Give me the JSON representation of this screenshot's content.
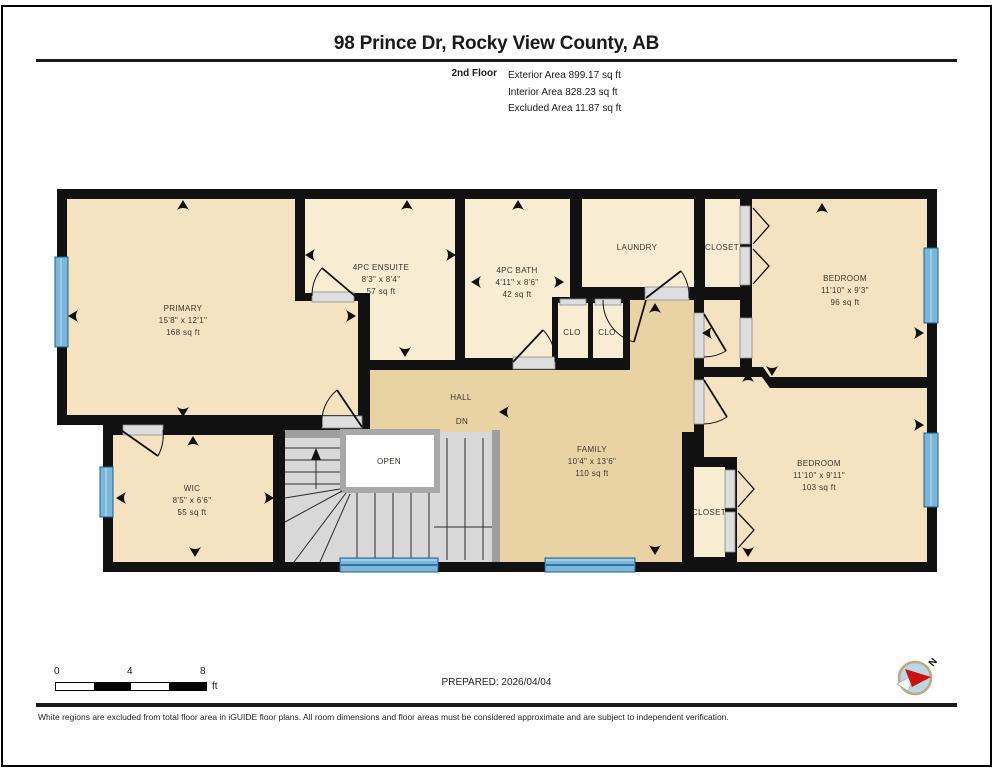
{
  "header": {
    "title": "98 Prince Dr, Rocky View County, AB",
    "floor_label": "2nd Floor",
    "area_lines": [
      "Exterior Area 899.17 sq ft",
      "Interior Area 828.23 sq ft",
      "Excluded Area 11.87 sq ft"
    ]
  },
  "plan": {
    "floor_name": "2nd Floor",
    "labels": [
      {
        "lines": [
          "PRIMARY",
          "15'8\" x 12'1\"",
          "168 sq ft"
        ],
        "x": 183,
        "y": 311
      },
      {
        "lines": [
          "4PC ENSUITE",
          "8'3\" x 8'4\"",
          "57 sq ft"
        ],
        "x": 381,
        "y": 270
      },
      {
        "lines": [
          "4PC BATH",
          "4'11\" x 8'6\"",
          "42 sq ft"
        ],
        "x": 517,
        "y": 273
      },
      {
        "lines": [
          "LAUNDRY"
        ],
        "x": 637,
        "y": 250
      },
      {
        "lines": [
          "CLOSET"
        ],
        "x": 722,
        "y": 250
      },
      {
        "lines": [
          "BEDROOM",
          "11'10\" x 9'3\"",
          "96 sq ft"
        ],
        "x": 845,
        "y": 281
      },
      {
        "lines": [
          "CLO"
        ],
        "x": 572,
        "y": 335
      },
      {
        "lines": [
          "CLO"
        ],
        "x": 607,
        "y": 335
      },
      {
        "lines": [
          "HALL"
        ],
        "x": 461,
        "y": 400
      },
      {
        "lines": [
          "DN"
        ],
        "x": 462,
        "y": 424
      },
      {
        "lines": [
          "OPEN"
        ],
        "x": 389,
        "y": 464
      },
      {
        "lines": [
          "FAMILY",
          "10'4\" x 13'6\"",
          "110 sq ft"
        ],
        "x": 592,
        "y": 452
      },
      {
        "lines": [
          "WIC",
          "8'5\" x 6'6\"",
          "55 sq ft"
        ],
        "x": 192,
        "y": 491
      },
      {
        "lines": [
          "CLOSET"
        ],
        "x": 709,
        "y": 515
      },
      {
        "lines": [
          "BEDROOM",
          "11'10\" x 9'11\"",
          "103 sq ft"
        ],
        "x": 819,
        "y": 466
      }
    ],
    "compass_label": "N"
  },
  "footer": {
    "scale": {
      "start": "0",
      "mid": "4",
      "end": "8",
      "unit": "ft"
    },
    "prepared": "PREPARED: 2026/04/04",
    "disclaimer": "White regions are excluded from total floor area in iGUIDE floor plans. All room dimensions and floor areas must be considered approximate and are subject to independent verification."
  },
  "colors": {
    "wall": "#111111",
    "room_tan": "#f5e2c0",
    "room_cream": "#f8ecd3",
    "hall_tan": "#e9d3a5",
    "stairs_gray": "#d8d8d8",
    "window_blue": "#7cb7d9",
    "compass_red": "#cc1111"
  }
}
